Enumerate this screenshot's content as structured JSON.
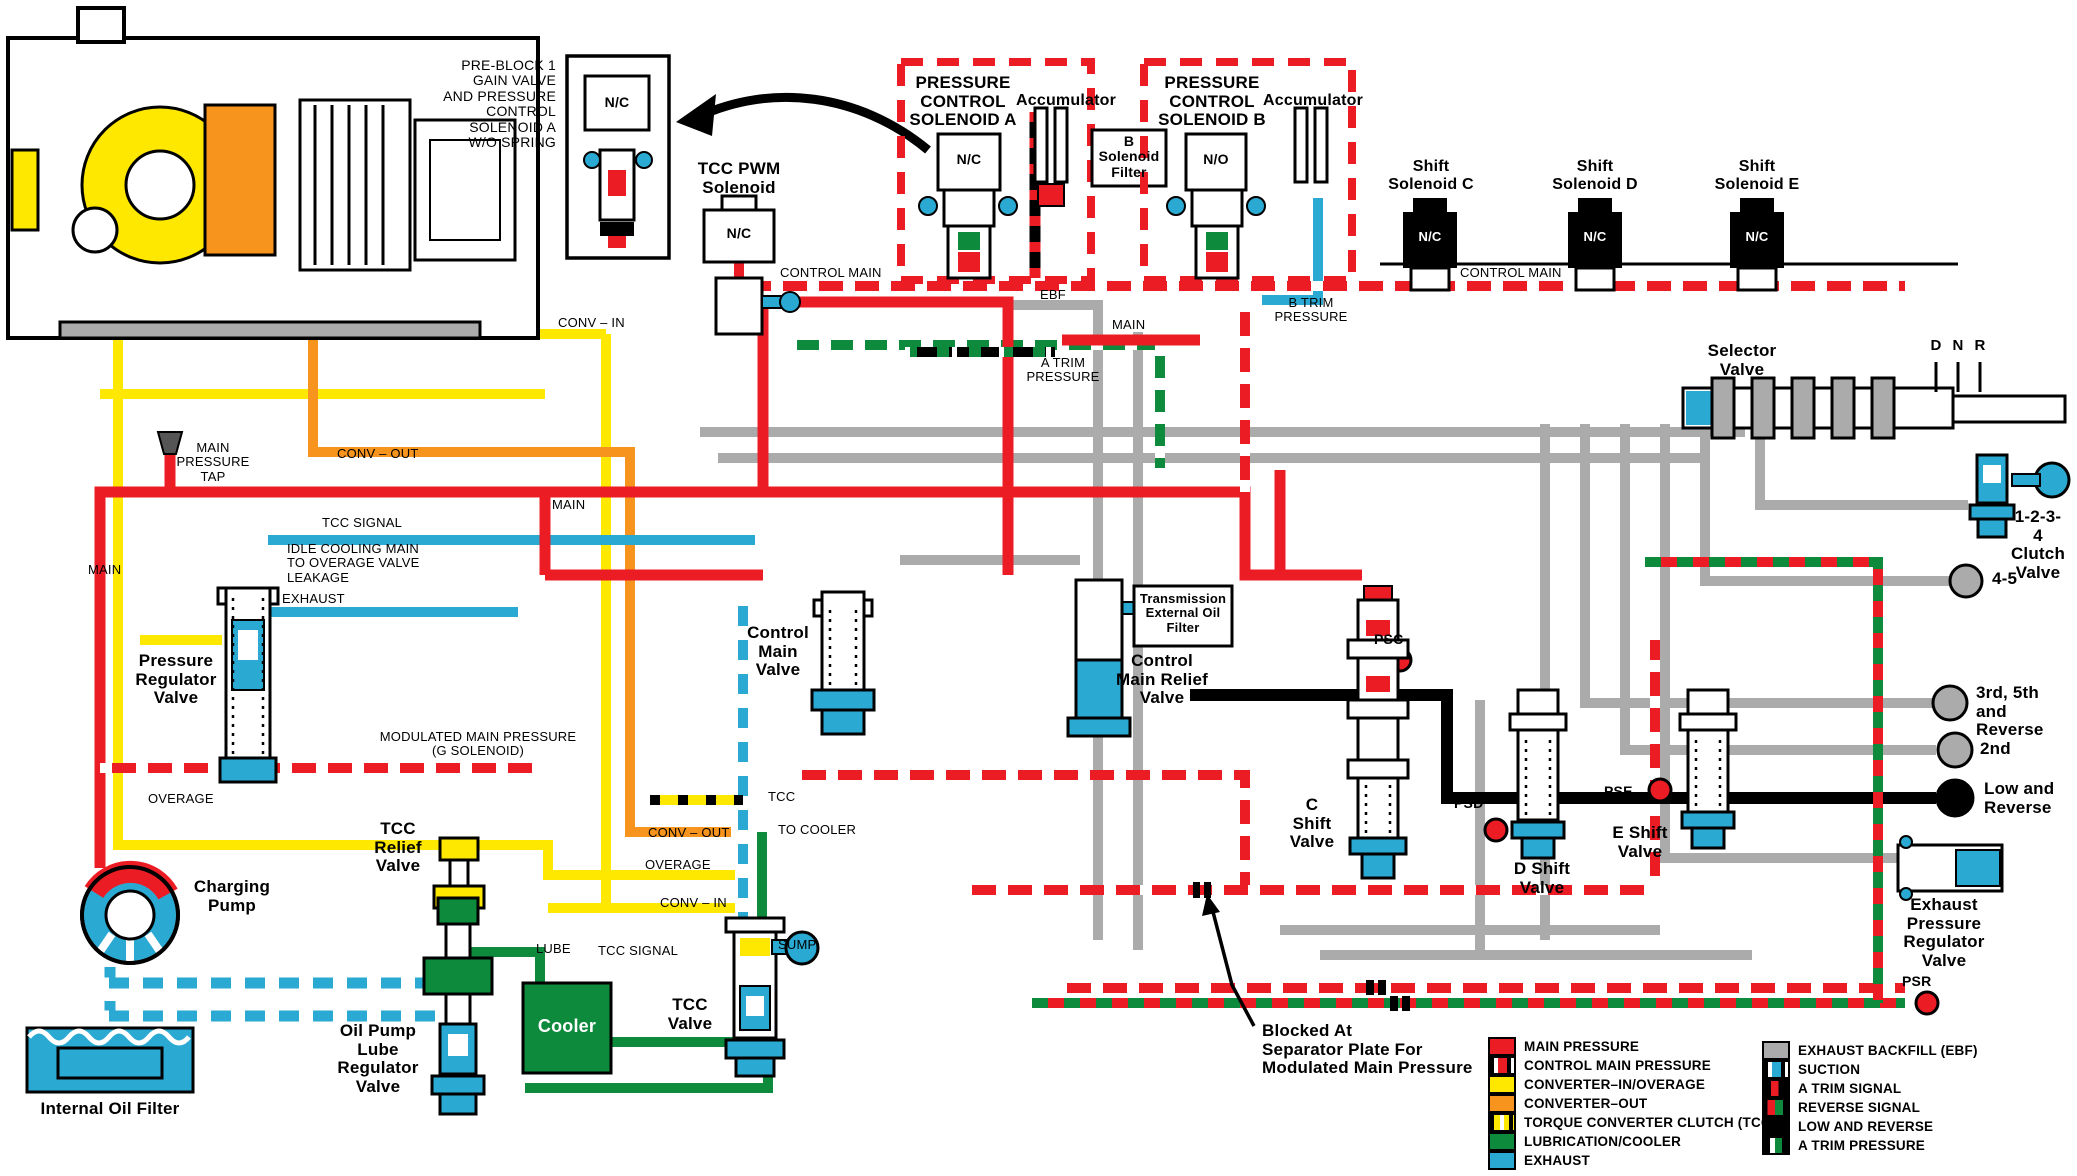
{
  "colors": {
    "main_pressure": "#EC1C24",
    "converter_in_overage": "#FFE800",
    "converter_out": "#F7941D",
    "lubrication_cooler": "#0E8A3C",
    "exhaust": "#2AA9D2",
    "exhaust_backfill": "#ABABAB",
    "low_and_reverse": "#000000"
  },
  "labels": [
    {
      "name": "pre-block-note",
      "text": "PRE-BLOCK 1\nGAIN VALVE\nAND PRESSURE\nCONTROL\nSOLENOID A\nW/O SPRING",
      "x": 556,
      "y": 58,
      "align": "right",
      "size": 14
    },
    {
      "name": "pre-block-nc-label",
      "text": "N/C",
      "x": 617,
      "y": 95,
      "align": "center",
      "size": 14,
      "bold": 1
    },
    {
      "name": "tcc-pwm-solenoid-label",
      "text": "TCC PWM\nSolenoid",
      "x": 739,
      "y": 160,
      "align": "center",
      "size": 17,
      "bold": 1
    },
    {
      "name": "tcc-pwm-nc-label",
      "text": "N/C",
      "x": 739,
      "y": 226,
      "align": "center",
      "size": 14,
      "bold": 1
    },
    {
      "name": "pressure-control-solenoid-a-label",
      "text": "PRESSURE\nCONTROL\nSOLENOID A",
      "x": 963,
      "y": 74,
      "align": "center",
      "size": 17,
      "bold": 1
    },
    {
      "name": "pcs-a-nc-label",
      "text": "N/C",
      "x": 969,
      "y": 152,
      "align": "center",
      "size": 14,
      "bold": 1
    },
    {
      "name": "accumulator-a-label",
      "text": "Accumulator",
      "x": 1066,
      "y": 92,
      "align": "center",
      "size": 16,
      "bold": 1
    },
    {
      "name": "b-solenoid-filter-label",
      "text": "B\nSolenoid\nFilter",
      "x": 1129,
      "y": 134,
      "align": "center",
      "size": 14,
      "bold": 1
    },
    {
      "name": "pressure-control-solenoid-b-label",
      "text": "PRESSURE\nCONTROL\nSOLENOID B",
      "x": 1212,
      "y": 74,
      "align": "center",
      "size": 17,
      "bold": 1
    },
    {
      "name": "pcs-b-no-label",
      "text": "N/O",
      "x": 1216,
      "y": 152,
      "align": "center",
      "size": 14,
      "bold": 1
    },
    {
      "name": "accumulator-b-label",
      "text": "Accumulator",
      "x": 1313,
      "y": 92,
      "align": "center",
      "size": 16,
      "bold": 1
    },
    {
      "name": "shift-solenoid-c-label",
      "text": "Shift\nSolenoid C",
      "x": 1431,
      "y": 158,
      "align": "center",
      "size": 16,
      "bold": 1
    },
    {
      "name": "shift-solenoid-c-nc",
      "text": "N/C",
      "x": 1430,
      "y": 230,
      "align": "center",
      "size": 13,
      "bold": 1,
      "color": "#fff"
    },
    {
      "name": "shift-solenoid-d-label",
      "text": "Shift\nSolenoid D",
      "x": 1595,
      "y": 158,
      "align": "center",
      "size": 16,
      "bold": 1
    },
    {
      "name": "shift-solenoid-d-nc",
      "text": "N/C",
      "x": 1595,
      "y": 230,
      "align": "center",
      "size": 13,
      "bold": 1,
      "color": "#fff"
    },
    {
      "name": "shift-solenoid-e-label",
      "text": "Shift\nSolenoid E",
      "x": 1757,
      "y": 158,
      "align": "center",
      "size": 16,
      "bold": 1
    },
    {
      "name": "shift-solenoid-e-nc",
      "text": "N/C",
      "x": 1757,
      "y": 230,
      "align": "center",
      "size": 13,
      "bold": 1,
      "color": "#fff"
    },
    {
      "name": "control-main-label-left",
      "text": "CONTROL MAIN",
      "x": 780,
      "y": 266,
      "size": 13
    },
    {
      "name": "control-main-label-right",
      "text": "CONTROL MAIN",
      "x": 1460,
      "y": 266,
      "size": 13
    },
    {
      "name": "ebf-label",
      "text": "EBF",
      "x": 1040,
      "y": 288,
      "size": 13
    },
    {
      "name": "main-label-mid",
      "text": "MAIN",
      "x": 1112,
      "y": 318,
      "size": 13
    },
    {
      "name": "a-trim-pressure-label",
      "text": "A TRIM\nPRESSURE",
      "x": 1063,
      "y": 356,
      "align": "center",
      "size": 13
    },
    {
      "name": "b-trim-pressure-label",
      "text": "B TRIM\nPRESSURE",
      "x": 1311,
      "y": 296,
      "align": "center",
      "size": 13
    },
    {
      "name": "conv-in-label-top",
      "text": "CONV – IN",
      "x": 558,
      "y": 316,
      "size": 13
    },
    {
      "name": "conv-out-label-left",
      "text": "CONV – OUT",
      "x": 337,
      "y": 447,
      "size": 13
    },
    {
      "name": "main-pressure-tap-label",
      "text": "MAIN\nPRESSURE\nTAP",
      "x": 213,
      "y": 441,
      "align": "center",
      "size": 13
    },
    {
      "name": "main-label-top",
      "text": "MAIN",
      "x": 552,
      "y": 498,
      "size": 13
    },
    {
      "name": "main-label-left",
      "text": "MAIN",
      "x": 88,
      "y": 563,
      "size": 13
    },
    {
      "name": "tcc-signal-label-left",
      "text": "TCC SIGNAL",
      "x": 322,
      "y": 516,
      "size": 13
    },
    {
      "name": "idle-cooling-note",
      "text": "IDLE COOLING MAIN\nTO OVERAGE VALVE\nLEAKAGE",
      "x": 287,
      "y": 542,
      "size": 13
    },
    {
      "name": "exhaust-label",
      "text": "EXHAUST",
      "x": 282,
      "y": 592,
      "size": 13
    },
    {
      "name": "pressure-regulator-valve-label",
      "text": "Pressure\nRegulator\nValve",
      "x": 176,
      "y": 652,
      "align": "center",
      "size": 17,
      "bold": 1
    },
    {
      "name": "modulated-main-label",
      "text": "MODULATED MAIN PRESSURE\n(G SOLENOID)",
      "x": 478,
      "y": 730,
      "align": "center",
      "size": 13
    },
    {
      "name": "overage-label-left",
      "text": "OVERAGE",
      "x": 148,
      "y": 792,
      "size": 13
    },
    {
      "name": "tcc-relief-valve-label",
      "text": "TCC\nRelief\nValve",
      "x": 398,
      "y": 820,
      "align": "center",
      "size": 17,
      "bold": 1
    },
    {
      "name": "charging-pump-label",
      "text": "Charging\nPump",
      "x": 232,
      "y": 878,
      "align": "center",
      "size": 17,
      "bold": 1
    },
    {
      "name": "tcc-port-label",
      "text": "TCC",
      "x": 768,
      "y": 790,
      "size": 13
    },
    {
      "name": "conv-out-label-mid",
      "text": "CONV – OUT",
      "x": 648,
      "y": 826,
      "size": 13
    },
    {
      "name": "to-cooler-label",
      "text": "TO COOLER",
      "x": 778,
      "y": 823,
      "size": 13
    },
    {
      "name": "overage-label-mid",
      "text": "OVERAGE",
      "x": 645,
      "y": 858,
      "size": 13
    },
    {
      "name": "conv-in-label-mid",
      "text": "CONV – IN",
      "x": 660,
      "y": 896,
      "size": 13
    },
    {
      "name": "lube-label",
      "text": "LUBE",
      "x": 536,
      "y": 942,
      "size": 13
    },
    {
      "name": "tcc-signal-label-mid",
      "text": "TCC SIGNAL",
      "x": 598,
      "y": 944,
      "size": 13
    },
    {
      "name": "sump-label",
      "text": "SUMP",
      "x": 778,
      "y": 938,
      "size": 13
    },
    {
      "name": "cooler-label",
      "text": "Cooler",
      "x": 567,
      "y": 1017,
      "align": "center",
      "size": 18,
      "bold": 1,
      "color": "#fff"
    },
    {
      "name": "tcc-valve-label",
      "text": "TCC\nValve",
      "x": 690,
      "y": 996,
      "align": "center",
      "size": 17,
      "bold": 1
    },
    {
      "name": "oil-pump-lube-regulator-label",
      "text": "Oil Pump\nLube\nRegulator\nValve",
      "x": 378,
      "y": 1022,
      "align": "center",
      "size": 17,
      "bold": 1
    },
    {
      "name": "internal-oil-filter-label",
      "text": "Internal Oil Filter",
      "x": 110,
      "y": 1100,
      "align": "center",
      "size": 17,
      "bold": 1
    },
    {
      "name": "control-main-valve-label",
      "text": "Control\nMain\nValve",
      "x": 778,
      "y": 624,
      "align": "center",
      "size": 17,
      "bold": 1
    },
    {
      "name": "control-main-relief-valve-label",
      "text": "Control\nMain Relief\nValve",
      "x": 1162,
      "y": 652,
      "align": "center",
      "size": 17,
      "bold": 1
    },
    {
      "name": "transmission-external-oil-filter-label",
      "text": "Transmission\nExternal Oil\nFilter",
      "x": 1183,
      "y": 592,
      "align": "center",
      "size": 13,
      "bold": 1
    },
    {
      "name": "c-shift-valve-label",
      "text": "C\nShift\nValve",
      "x": 1312,
      "y": 796,
      "align": "center",
      "size": 17,
      "bold": 1
    },
    {
      "name": "psc-label",
      "text": "PSC",
      "x": 1374,
      "y": 632,
      "size": 14,
      "bold": 1
    },
    {
      "name": "psd-label",
      "text": "PSD",
      "x": 1454,
      "y": 796,
      "size": 14,
      "bold": 1
    },
    {
      "name": "d-shift-valve-label",
      "text": "D Shift\nValve",
      "x": 1542,
      "y": 860,
      "align": "center",
      "size": 17,
      "bold": 1
    },
    {
      "name": "pse-label",
      "text": "PSE",
      "x": 1604,
      "y": 784,
      "size": 14,
      "bold": 1
    },
    {
      "name": "e-shift-valve-label",
      "text": "E Shift\nValve",
      "x": 1640,
      "y": 824,
      "align": "center",
      "size": 17,
      "bold": 1
    },
    {
      "name": "selector-valve-label",
      "text": "Selector\nValve",
      "x": 1742,
      "y": 342,
      "align": "center",
      "size": 17,
      "bold": 1
    },
    {
      "name": "selector-d-label",
      "text": "D",
      "x": 1936,
      "y": 338,
      "align": "center",
      "size": 15,
      "bold": 1
    },
    {
      "name": "selector-n-label",
      "text": "N",
      "x": 1958,
      "y": 338,
      "align": "center",
      "size": 15,
      "bold": 1
    },
    {
      "name": "selector-r-label",
      "text": "R",
      "x": 1980,
      "y": 338,
      "align": "center",
      "size": 15,
      "bold": 1
    },
    {
      "name": "clutch-1-2-3-4-label",
      "text": "1-2-3-4\nClutch\nValve",
      "x": 2038,
      "y": 508,
      "align": "center",
      "size": 17,
      "bold": 1
    },
    {
      "name": "label-4-5",
      "text": "4-5",
      "x": 1992,
      "y": 570,
      "size": 17,
      "bold": 1
    },
    {
      "name": "third-fifth-reverse-label",
      "text": "3rd, 5th\nand Reverse",
      "x": 1976,
      "y": 684,
      "size": 17,
      "bold": 1
    },
    {
      "name": "second-label",
      "text": "2nd",
      "x": 1980,
      "y": 740,
      "size": 17,
      "bold": 1
    },
    {
      "name": "low-and-reverse-label",
      "text": "Low and\nReverse",
      "x": 1984,
      "y": 780,
      "size": 17,
      "bold": 1
    },
    {
      "name": "exhaust-pressure-regulator-label",
      "text": "Exhaust\nPressure\nRegulator\nValve",
      "x": 1944,
      "y": 896,
      "align": "center",
      "size": 17,
      "bold": 1
    },
    {
      "name": "psr-label",
      "text": "PSR",
      "x": 1902,
      "y": 974,
      "size": 14,
      "bold": 1
    },
    {
      "name": "blocked-note",
      "text": "Blocked  At\nSeparator  Plate  For\nModulated  Main  Pressure",
      "x": 1262,
      "y": 1022,
      "size": 17,
      "bold": 1
    }
  ],
  "legend": {
    "left": [
      {
        "key": "main-pressure",
        "label": "MAIN PRESSURE"
      },
      {
        "key": "control-main-pressure",
        "label": "CONTROL MAIN PRESSURE"
      },
      {
        "key": "converter-in-overage",
        "label": "CONVERTER–IN/OVERAGE"
      },
      {
        "key": "converter-out",
        "label": "CONVERTER–OUT"
      },
      {
        "key": "torque-converter-clutch",
        "label": "TORQUE CONVERTER CLUTCH (TCC)"
      },
      {
        "key": "lubrication-cooler",
        "label": "LUBRICATION/COOLER"
      },
      {
        "key": "exhaust",
        "label": "EXHAUST"
      }
    ],
    "right": [
      {
        "key": "exhaust-backfill",
        "label": "EXHAUST BACKFILL (EBF)"
      },
      {
        "key": "suction",
        "label": "SUCTION"
      },
      {
        "key": "a-trim-signal",
        "label": "A TRIM SIGNAL"
      },
      {
        "key": "reverse-signal",
        "label": "REVERSE SIGNAL"
      },
      {
        "key": "low-and-reverse",
        "label": "LOW AND REVERSE"
      },
      {
        "key": "a-trim-pressure",
        "label": "A TRIM PRESSURE"
      }
    ]
  }
}
